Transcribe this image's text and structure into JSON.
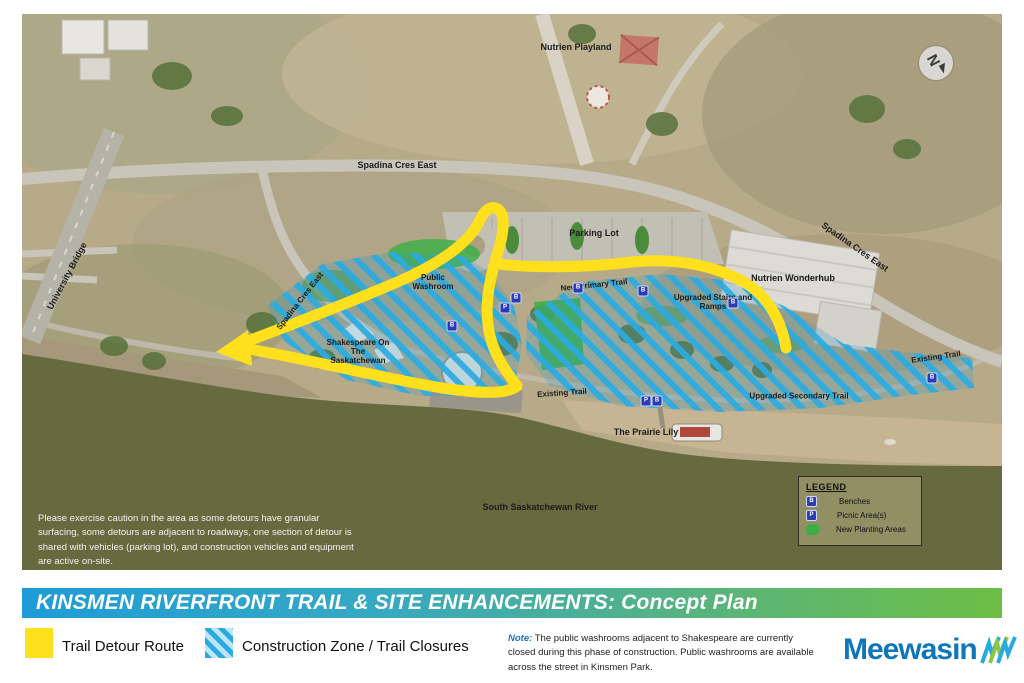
{
  "title_bar": {
    "text": "KINSMEN RIVERFRONT TRAIL & SITE ENHANCEMENTS: Concept Plan",
    "gradient_start": "#1E9CD7",
    "gradient_end": "#6DBE45"
  },
  "map": {
    "compass_letter": "N",
    "labels": {
      "nutrien_playland": "Nutrien Playland",
      "spadina_top": "Spadina Cres East",
      "spadina_right": "Spadina Cres East",
      "spadina_left": "Spadina Cres East",
      "university_bridge": "University Bridge",
      "parking_lot": "Parking Lot",
      "nutrien_wonderhub": "Nutrien Wonderhub",
      "upgraded_stairs": "Upgraded Stairs and Ramps",
      "public_washroom": "Public Washroom",
      "new_primary_trail": "New Primary Trail",
      "shakespeare": "Shakespeare On The Saskatchewan",
      "existing_trail_mid": "Existing Trail",
      "prairie_lily": "The Prairie Lily",
      "upgraded_secondary_trail": "Upgraded Secondary Trail",
      "existing_trail_right": "Existing Trail",
      "river": "South Saskatchewan River"
    },
    "caution_text": "Please exercise caution in the area as some detours have granular surfacing, some detours are adjacent to roadways, one section of detour is shared with vehicles (parking lot), and construction vehicles and equipment are active on-site.",
    "legend_box": {
      "title": "LEGEND",
      "items": [
        {
          "icon": "bench-marker",
          "label": "Benches"
        },
        {
          "icon": "picnic-marker",
          "label": "Picnic Area(s)"
        },
        {
          "icon": "planting-area",
          "label": "New Planting Areas"
        }
      ]
    },
    "marker_letters": {
      "bench": "B",
      "picnic": "P"
    },
    "colors": {
      "detour_yellow": "#FFE01C",
      "construction_blue": "#29ABE2",
      "planting_green": "#3FAE49",
      "river_olive": "#67693F",
      "marker_blue": "#2B3BB5"
    }
  },
  "footer": {
    "legend": [
      {
        "label": "Trail Detour Route"
      },
      {
        "label": "Construction Zone / Trail Closures"
      }
    ],
    "note_label": "Note:",
    "note_text": " The public washrooms adjacent to Shakespeare are currently closed during this phase of construction. Public washrooms are available across the street in Kinsmen Park.",
    "brand": "Meewasin"
  }
}
